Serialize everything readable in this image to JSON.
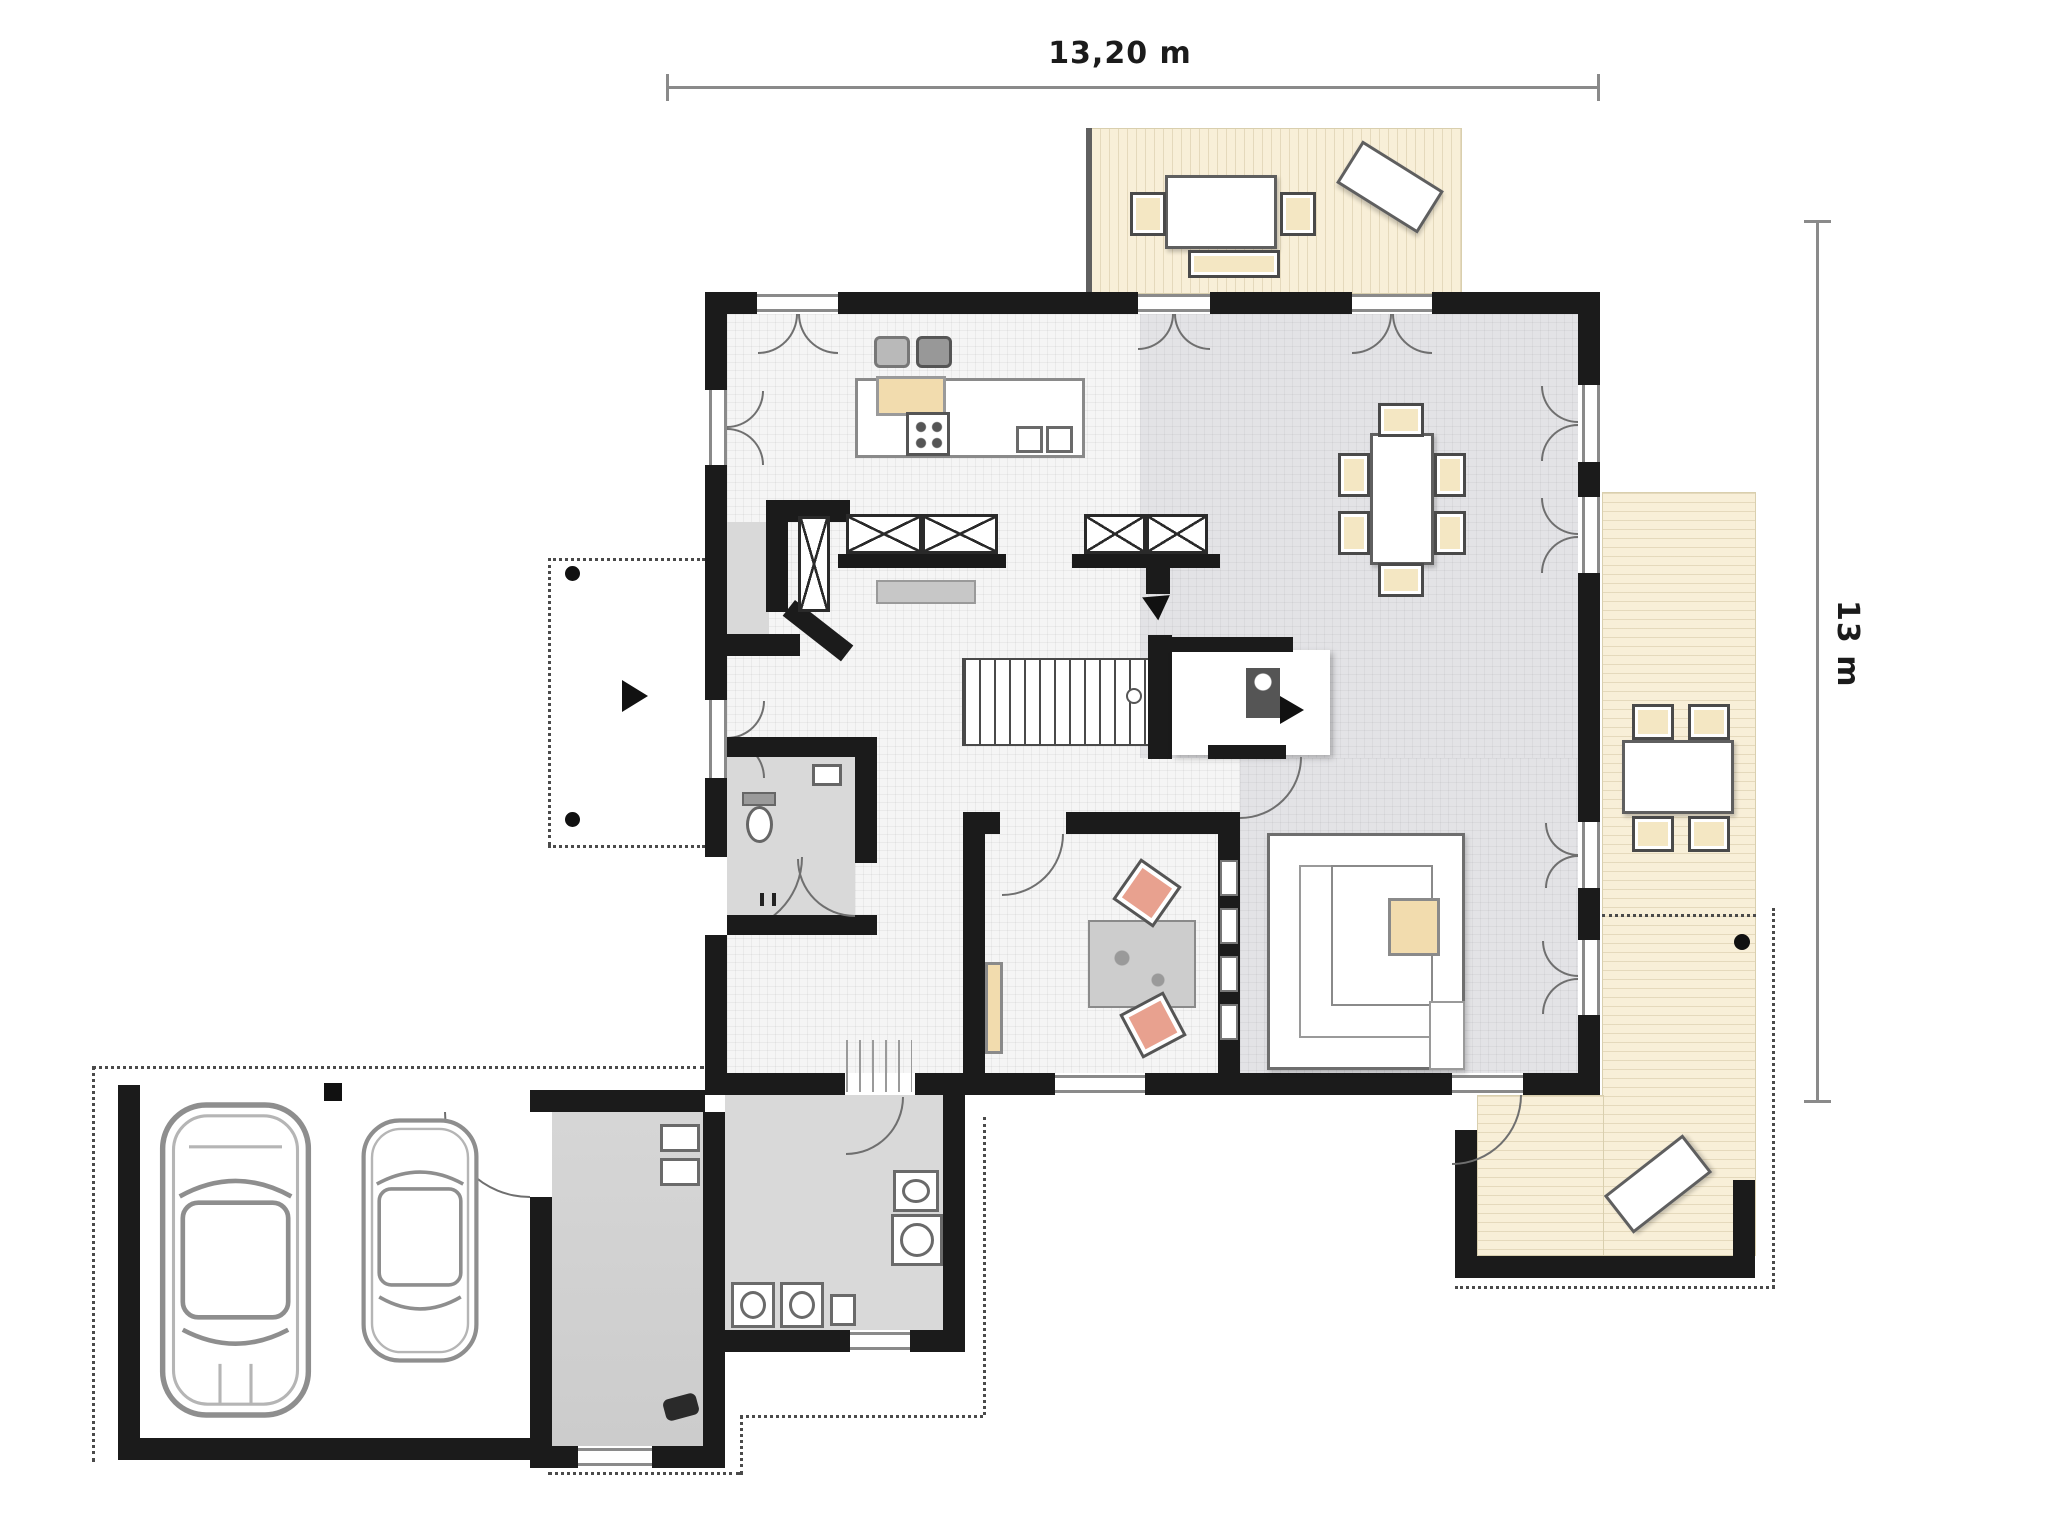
{
  "type": "architectural-floor-plan",
  "dimensions": {
    "horizontal": "13,20 m",
    "vertical": "13 m"
  },
  "palette": {
    "wall": "#1b1b1b",
    "floor_light": "#f5f5f5",
    "floor_dark": "#e3e3e6",
    "floor_service": "#d9d9d9",
    "terrace": "#f8efd8",
    "wood": "#f2dcae",
    "chair_cushion": "#f4e7c3",
    "chair_salmon": "#e8a18f",
    "dimension_line": "#8a8a8a",
    "page_background": "#ffffff"
  },
  "areas": [
    "kitchen",
    "hallway",
    "pantry",
    "bathroom",
    "dining-room",
    "living-room",
    "study",
    "utility-room",
    "mudroom",
    "carport",
    "north-terrace",
    "east-terrace",
    "entrance-porch"
  ],
  "furniture_icons": [
    "kitchen-island",
    "stove",
    "double-sink",
    "refrigerator",
    "wardrobe-x",
    "dining-table",
    "corner-sofa",
    "coffee-table",
    "desk",
    "desk-chair",
    "stairs",
    "fireplace",
    "toilet",
    "washbasin",
    "washer",
    "garden-table",
    "garden-chair",
    "lounge-chair",
    "bench",
    "car"
  ]
}
